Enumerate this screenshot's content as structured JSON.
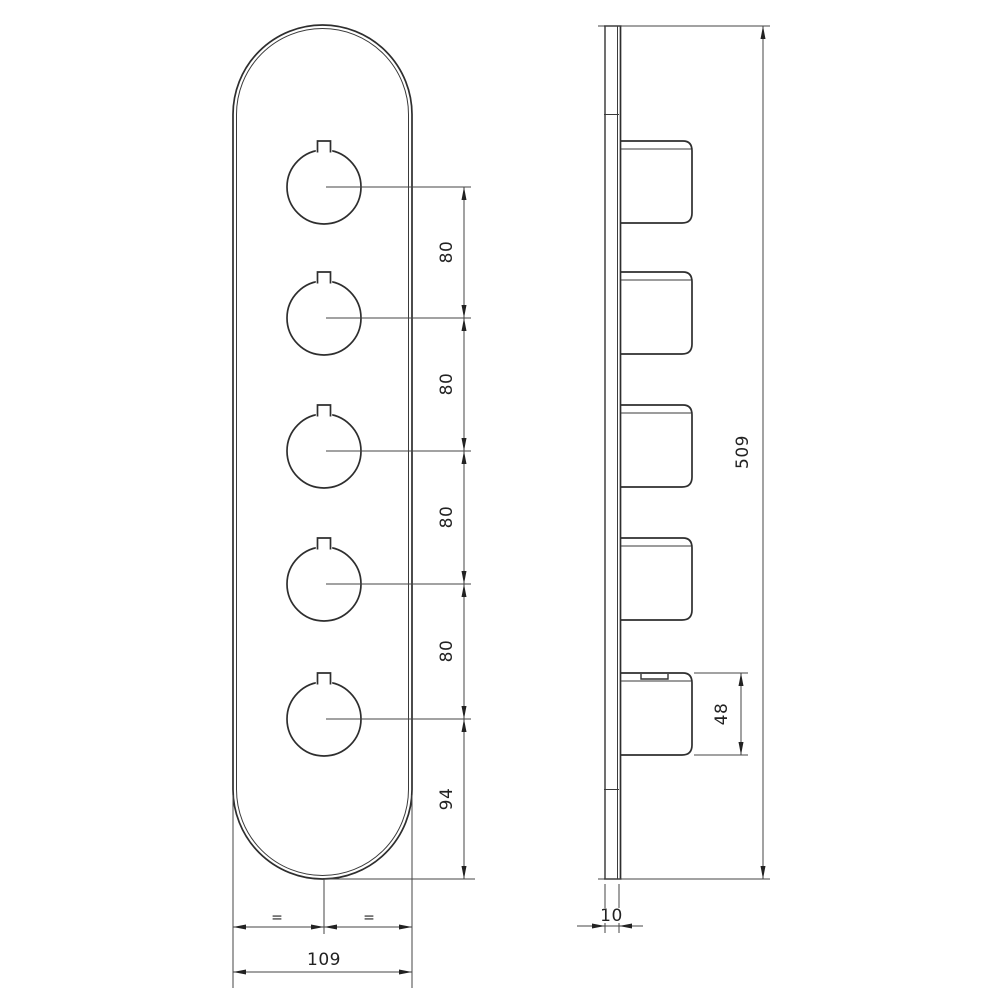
{
  "drawing": {
    "type": "technical-dimension-drawing",
    "views": {
      "front": "valve-trim-plate-front-view",
      "side": "valve-trim-plate-side-view"
    },
    "dimensions": {
      "knob_spacings": [
        "80",
        "80",
        "80",
        "80"
      ],
      "bottom_offset": "94",
      "plate_width": "109",
      "plate_height": "509",
      "knob_height": "48",
      "plate_thickness": "10",
      "equal_marks": [
        "=",
        "="
      ]
    },
    "colors": {
      "background": "#ffffff",
      "object_line": "#2e2e2e",
      "dimension_line": "#454545",
      "text": "#222222"
    }
  }
}
